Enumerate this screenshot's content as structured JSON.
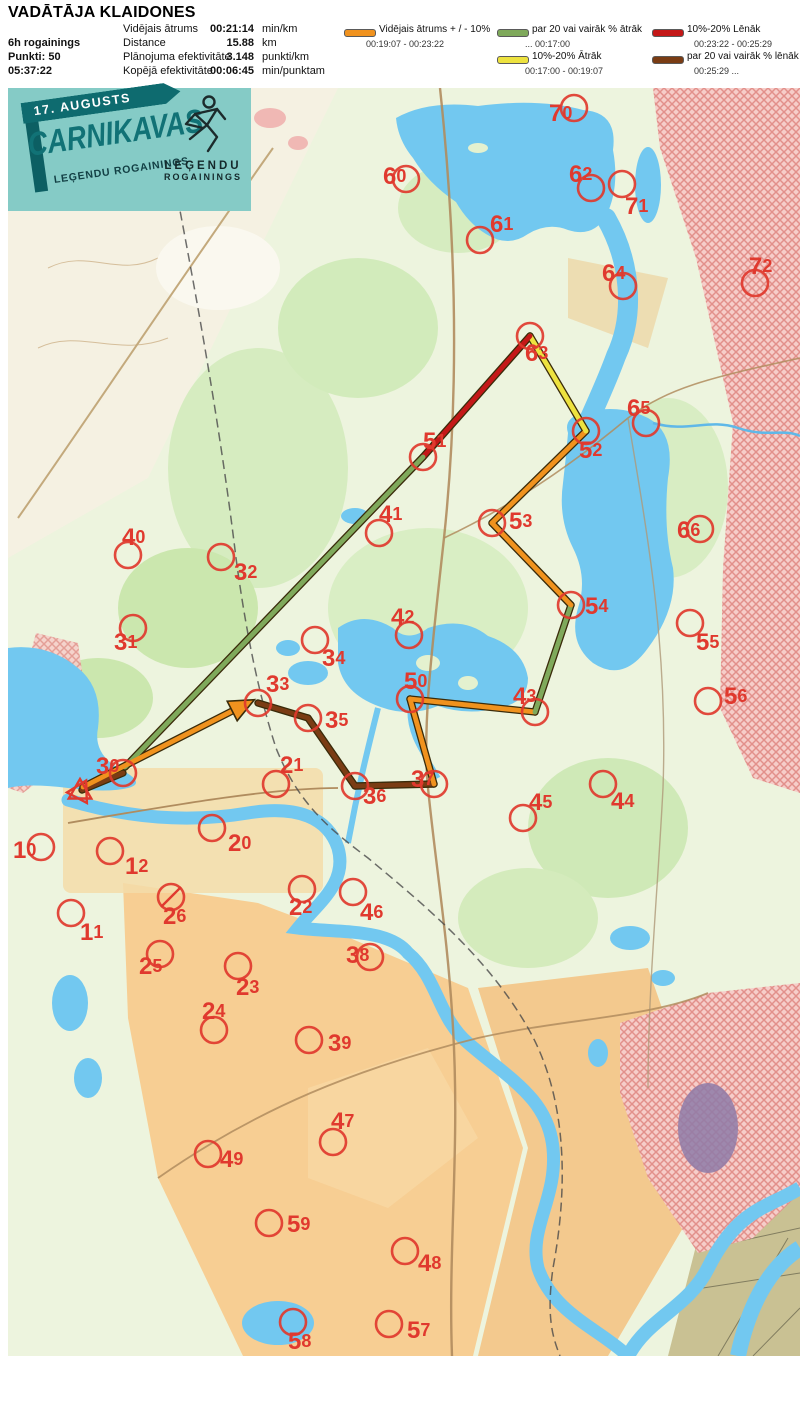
{
  "header": {
    "title": "VADĀTĀJA KLAIDONES",
    "left": [
      "6h rogainings",
      "Punkti: 50",
      "05:37:22"
    ],
    "stats": [
      {
        "label": "Vidējais ātrums",
        "value": "00:21:14",
        "unit": "min/km"
      },
      {
        "label": "Distance",
        "value": "15.88",
        "unit": "km"
      },
      {
        "label": "Plānojuma efektivitāte",
        "value": "3.148",
        "unit": "punkti/km"
      },
      {
        "label": "Kopējā efektivitāte",
        "value": "00:06:45",
        "unit": "min/punktam"
      }
    ],
    "legend": [
      {
        "label": "Vidējais ātrums + / - 10%",
        "range": "00:19:07   -   00:23:22",
        "color": "#F0921E"
      },
      {
        "label": "par 20 vai vairāk % ātrāk",
        "range": "...    00:17:00",
        "color": "#7FA95B"
      },
      {
        "label": "10%-20% Ātrāk",
        "range": "00:17:00   -   00:19:07",
        "color": "#EDE23F"
      },
      {
        "label": "10%-20% Lēnāk",
        "range": "00:23:22   - 00:25:29",
        "color": "#C41818"
      },
      {
        "label": "par 20 vai vairāk % lēnāk",
        "range": "00:25:29   ...",
        "color": "#7A3C14"
      }
    ]
  },
  "logo": {
    "date_banner": "17. AUGUSTS",
    "title": "CARNIKAVAS",
    "subtitle": "LEĢENDU ROGAININGS",
    "emblem_line1": "LEĢENDU",
    "emblem_line2": "ROGAININGS"
  },
  "map": {
    "colors": {
      "control": "#E0392E",
      "avg": "#F0921E",
      "fast20": "#7FA95B",
      "fast10": "#EDE23F",
      "slow10": "#C41818",
      "slow20": "#7A3C14",
      "outline": "#3A2B0A",
      "water": "#72C8F0"
    },
    "start": {
      "x": 72,
      "y": 704
    },
    "route_legs": [
      {
        "x1": 250,
        "y1": 615,
        "x2": 300,
        "y2": 630,
        "cat": "slow20"
      },
      {
        "x1": 300,
        "y1": 630,
        "x2": 347,
        "y2": 698,
        "cat": "slow20"
      },
      {
        "x1": 347,
        "y1": 698,
        "x2": 426,
        "y2": 696,
        "cat": "slow20"
      },
      {
        "x1": 426,
        "y1": 696,
        "x2": 402,
        "y2": 611,
        "cat": "avg"
      },
      {
        "x1": 402,
        "y1": 611,
        "x2": 527,
        "y2": 624,
        "cat": "avg"
      },
      {
        "x1": 527,
        "y1": 624,
        "x2": 563,
        "y2": 517,
        "cat": "fast20"
      },
      {
        "x1": 563,
        "y1": 517,
        "x2": 484,
        "y2": 435,
        "cat": "avg"
      },
      {
        "x1": 484,
        "y1": 435,
        "x2": 578,
        "y2": 343,
        "cat": "avg"
      },
      {
        "x1": 578,
        "y1": 343,
        "x2": 522,
        "y2": 248,
        "cat": "fast10"
      },
      {
        "x1": 522,
        "y1": 248,
        "x2": 415,
        "y2": 369,
        "cat": "slow10"
      },
      {
        "x1": 415,
        "y1": 369,
        "x2": 117,
        "y2": 679,
        "cat": "fast20"
      },
      {
        "x1": 115,
        "y1": 685,
        "x2": 74,
        "y2": 702,
        "cat": "slow20"
      },
      {
        "x1": 75,
        "y1": 699,
        "x2": 234,
        "y2": 618,
        "cat": "avg",
        "arrow": true
      }
    ],
    "controls": [
      {
        "n": "10",
        "cx": 33,
        "cy": 759,
        "lx": 5,
        "ly": 762
      },
      {
        "n": "11",
        "cx": 63,
        "cy": 825,
        "lx": 72,
        "ly": 844
      },
      {
        "n": "12",
        "cx": 102,
        "cy": 763,
        "lx": 117,
        "ly": 778
      },
      {
        "n": "20",
        "cx": 204,
        "cy": 740,
        "lx": 220,
        "ly": 755
      },
      {
        "n": "21",
        "cx": 268,
        "cy": 696,
        "lx": 272,
        "ly": 677
      },
      {
        "n": "22",
        "cx": 294,
        "cy": 801,
        "lx": 281,
        "ly": 819
      },
      {
        "n": "23",
        "cx": 230,
        "cy": 878,
        "lx": 228,
        "ly": 899
      },
      {
        "n": "24",
        "cx": 206,
        "cy": 942,
        "lx": 194,
        "ly": 923
      },
      {
        "n": "25",
        "cx": 152,
        "cy": 866,
        "lx": 131,
        "ly": 878
      },
      {
        "n": "26",
        "cx": 163,
        "cy": 809,
        "lx": 155,
        "ly": 828,
        "crossed": true
      },
      {
        "n": "30",
        "cx": 115,
        "cy": 685,
        "lx": 88,
        "ly": 678
      },
      {
        "n": "31",
        "cx": 125,
        "cy": 540,
        "lx": 106,
        "ly": 554
      },
      {
        "n": "32",
        "cx": 213,
        "cy": 469,
        "lx": 226,
        "ly": 484
      },
      {
        "n": "33",
        "cx": 250,
        "cy": 615,
        "lx": 258,
        "ly": 596
      },
      {
        "n": "34",
        "cx": 307,
        "cy": 552,
        "lx": 314,
        "ly": 570
      },
      {
        "n": "35",
        "cx": 300,
        "cy": 630,
        "lx": 317,
        "ly": 632
      },
      {
        "n": "36",
        "cx": 347,
        "cy": 698,
        "lx": 355,
        "ly": 708
      },
      {
        "n": "37",
        "cx": 426,
        "cy": 696,
        "lx": 403,
        "ly": 691
      },
      {
        "n": "38",
        "cx": 362,
        "cy": 869,
        "lx": 338,
        "ly": 867
      },
      {
        "n": "39",
        "cx": 301,
        "cy": 952,
        "lx": 320,
        "ly": 955
      },
      {
        "n": "40",
        "cx": 120,
        "cy": 467,
        "lx": 114,
        "ly": 449
      },
      {
        "n": "41",
        "cx": 371,
        "cy": 445,
        "lx": 371,
        "ly": 426
      },
      {
        "n": "42",
        "cx": 401,
        "cy": 547,
        "lx": 383,
        "ly": 529
      },
      {
        "n": "43",
        "cx": 527,
        "cy": 624,
        "lx": 505,
        "ly": 608
      },
      {
        "n": "44",
        "cx": 595,
        "cy": 696,
        "lx": 603,
        "ly": 713
      },
      {
        "n": "45",
        "cx": 515,
        "cy": 730,
        "lx": 521,
        "ly": 714
      },
      {
        "n": "46",
        "cx": 345,
        "cy": 804,
        "lx": 352,
        "ly": 824
      },
      {
        "n": "47",
        "cx": 325,
        "cy": 1054,
        "lx": 323,
        "ly": 1033
      },
      {
        "n": "48",
        "cx": 397,
        "cy": 1163,
        "lx": 410,
        "ly": 1175
      },
      {
        "n": "49",
        "cx": 200,
        "cy": 1066,
        "lx": 212,
        "ly": 1071
      },
      {
        "n": "50",
        "cx": 402,
        "cy": 611,
        "lx": 396,
        "ly": 593
      },
      {
        "n": "51",
        "cx": 415,
        "cy": 369,
        "lx": 415,
        "ly": 353
      },
      {
        "n": "52",
        "cx": 578,
        "cy": 343,
        "lx": 571,
        "ly": 362
      },
      {
        "n": "53",
        "cx": 484,
        "cy": 435,
        "lx": 501,
        "ly": 433
      },
      {
        "n": "54",
        "cx": 563,
        "cy": 517,
        "lx": 577,
        "ly": 518
      },
      {
        "n": "55",
        "cx": 682,
        "cy": 535,
        "lx": 688,
        "ly": 554
      },
      {
        "n": "56",
        "cx": 700,
        "cy": 613,
        "lx": 716,
        "ly": 608
      },
      {
        "n": "57",
        "cx": 381,
        "cy": 1236,
        "lx": 399,
        "ly": 1242
      },
      {
        "n": "58",
        "cx": 285,
        "cy": 1234,
        "lx": 280,
        "ly": 1253
      },
      {
        "n": "59",
        "cx": 261,
        "cy": 1135,
        "lx": 279,
        "ly": 1136
      },
      {
        "n": "60",
        "cx": 398,
        "cy": 91,
        "lx": 375,
        "ly": 88
      },
      {
        "n": "61",
        "cx": 472,
        "cy": 152,
        "lx": 482,
        "ly": 136
      },
      {
        "n": "62",
        "cx": 583,
        "cy": 100,
        "lx": 561,
        "ly": 86
      },
      {
        "n": "63",
        "cx": 522,
        "cy": 248,
        "lx": 517,
        "ly": 265
      },
      {
        "n": "64",
        "cx": 615,
        "cy": 198,
        "lx": 594,
        "ly": 185
      },
      {
        "n": "65",
        "cx": 638,
        "cy": 335,
        "lx": 619,
        "ly": 320
      },
      {
        "n": "66",
        "cx": 692,
        "cy": 441,
        "lx": 669,
        "ly": 442
      },
      {
        "n": "70",
        "cx": 566,
        "cy": 20,
        "lx": 541,
        "ly": 25
      },
      {
        "n": "71",
        "cx": 614,
        "cy": 96,
        "lx": 617,
        "ly": 118
      },
      {
        "n": "72",
        "cx": 747,
        "cy": 195,
        "lx": 741,
        "ly": 178
      }
    ]
  }
}
